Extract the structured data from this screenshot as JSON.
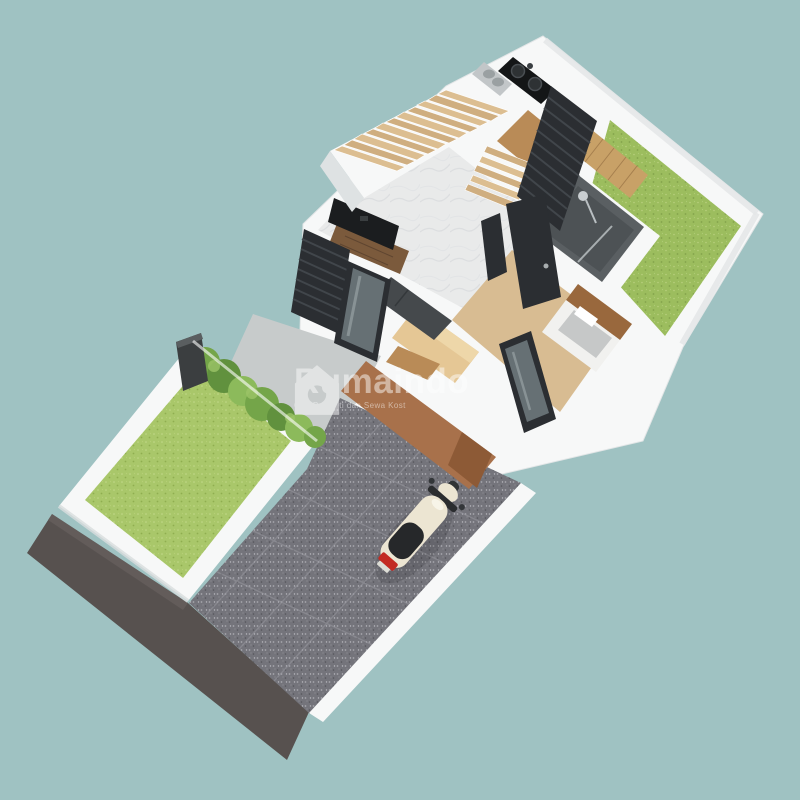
{
  "watermark": {
    "brand": "Rumaindo",
    "tagline": "Cari Properti dan Sewa Kost",
    "logo": "house-logo-icon"
  },
  "scene": {
    "description": "3D isometric render of a narrow single-storey house floor plan on a teal background",
    "elements": [
      "road",
      "gravel-carport",
      "scooter",
      "front-garden",
      "shrubs",
      "fence-post",
      "terrace",
      "living-room",
      "tv-console",
      "window-shutters",
      "sofa",
      "staircase",
      "kitchen",
      "cooktop",
      "sink",
      "hallway-doors",
      "bathroom",
      "shower",
      "bedroom",
      "bed",
      "wardrobe-island",
      "back-garden",
      "wood-deck",
      "brown-facade",
      "front-door",
      "boundary-walls"
    ]
  },
  "colors": {
    "background": "#9FC2C2",
    "road": "#57514F",
    "gravel": "#74747B",
    "gravel_grid": "#97979E",
    "concrete": "#C7CBCB",
    "wall": "#F7F8F8",
    "wall_shade": "#DEE2E3",
    "grass_front": "#A9C76A",
    "grass_back": "#9CBD5E",
    "shrub": "#74A549",
    "shrub_dark": "#61913E",
    "shrub_light": "#8CBA5B",
    "fence": "#3B3E40",
    "marble": "#E9EAEA",
    "wood_floor": "#B98B57",
    "wood_floor_light": "#D8BC92",
    "wood_deck": "#C8A167",
    "wood_light": "#E5C795",
    "stair_tread": "#DCBE91",
    "stair_tread_alt": "#CFAE80",
    "console": "#7B5A3C",
    "facade": "#A8714B",
    "door_brown": "#8D5A36",
    "headboard": "#99683D",
    "dark_panel": "#2B2E32",
    "dark_slat": "#41464B",
    "glass": "#667074",
    "bathroom_wall": "#5A5F62",
    "bathroom_floor": "#4D5255",
    "sofa": "#45494C",
    "tv": "#1B1D1F",
    "bed": "#F1F1EF",
    "blanket": "#C6C8C8",
    "scooter_body": "#ECE5D2",
    "scooter_seat": "#26282A",
    "scooter_tail": "#C32A22",
    "sink_metal": "#C2C6C8",
    "cooktop": "#141617"
  }
}
